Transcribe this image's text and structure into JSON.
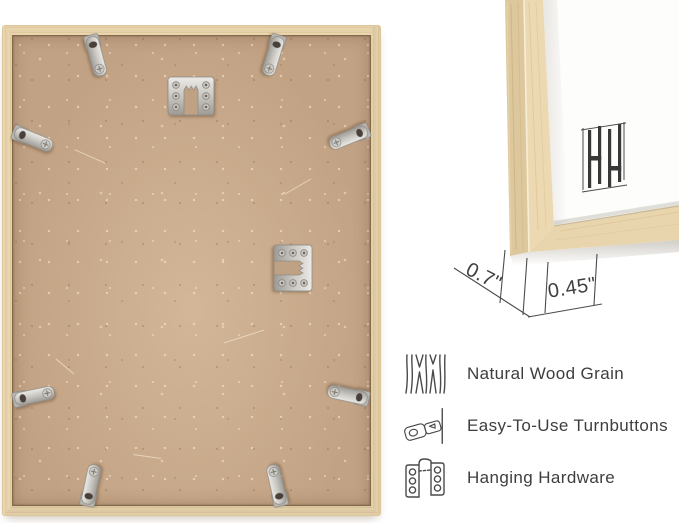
{
  "corner_detail": {
    "depth_label": "0.7\"",
    "face_label": "0.45\"",
    "logo": "HH-bars-brand-logo"
  },
  "features": [
    {
      "icon": "wood-grain-icon",
      "label": "Natural Wood Grain"
    },
    {
      "icon": "turnbutton-icon",
      "label": "Easy-To-Use Turnbuttons"
    },
    {
      "icon": "hanging-hardware-icon",
      "label": "Hanging Hardware"
    }
  ],
  "hardware": {
    "turnbutton_count": 8,
    "hanger_count": 2
  },
  "colors": {
    "background": "#ffffff",
    "wood_light": "#ecd9b4",
    "wood_mid": "#e3cda4",
    "wood_side": "#d9c094",
    "mdf": "#c2a284",
    "metal": "#c9c7c2",
    "text": "#3e3e3e",
    "dimension_line": "#4c4c4c",
    "logo": "#383838"
  }
}
